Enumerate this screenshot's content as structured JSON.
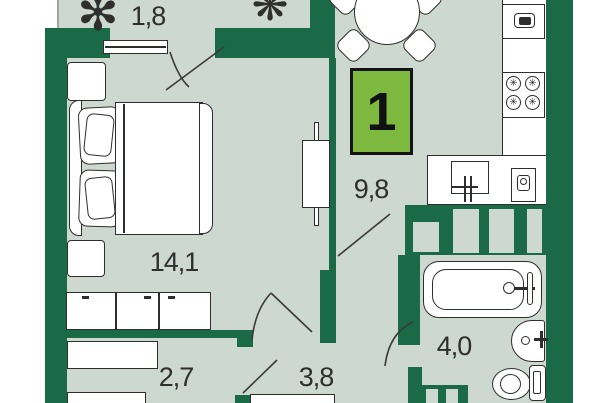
{
  "plan": {
    "title": "apartment-floor-plan",
    "badge_label": "1",
    "rooms": [
      {
        "name": "balcony",
        "area": "1,8"
      },
      {
        "name": "bedroom",
        "area": "14,1"
      },
      {
        "name": "kitchen-living",
        "area": "9,8"
      },
      {
        "name": "hallway",
        "area": "2,7"
      },
      {
        "name": "entry-corridor",
        "area": "3,8"
      },
      {
        "name": "bathroom",
        "area": "4,0"
      }
    ],
    "colors": {
      "wall": "#1a6a48",
      "floor": "#cdd8d0",
      "badge": "#7eb93f",
      "page_background": "#ffffff",
      "furniture_outline": "#2e2e2e"
    },
    "icons": {
      "plant_large": "✻",
      "plant_small": "❋",
      "stove_burner": "✳"
    }
  }
}
